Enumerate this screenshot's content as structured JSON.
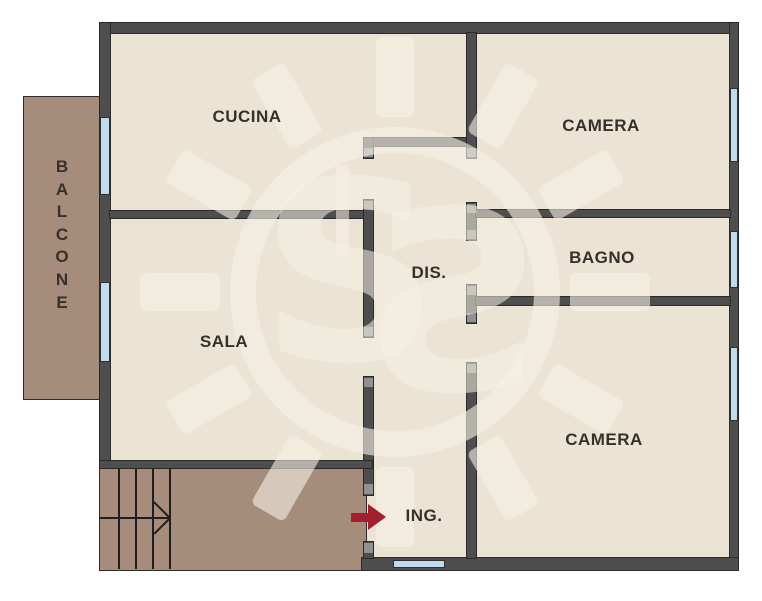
{
  "plan": {
    "rooms": {
      "cucina": {
        "label": "CUCINA"
      },
      "camera_nord": {
        "label": "CAMERA"
      },
      "bagno": {
        "label": "BAGNO"
      },
      "disimpegno": {
        "label": "DIS."
      },
      "sala": {
        "label": "SALA"
      },
      "camera_sud": {
        "label": "CAMERA"
      },
      "ingresso": {
        "label": "ING."
      },
      "balcone": {
        "label": "BALCONE"
      }
    },
    "watermark": {
      "letter": "S"
    },
    "features": {
      "entrance_arrow": "red-arrow-pointing-right-into-ING",
      "stairs": "staircase-with-up-arrow-bottom-left"
    },
    "colors": {
      "floor": "#EBE4D5",
      "wall": "#4E4E4E",
      "wall_outline": "#2A2A2A",
      "door_jamb": "#919191",
      "balcony_and_stairs": "#A68D7B",
      "window": "#BFDCEE",
      "entrance_arrow": "#A31F2E",
      "label_text": "#35302A",
      "watermark_tint": "#F7F1E6",
      "background": "#FFFFFF"
    }
  }
}
